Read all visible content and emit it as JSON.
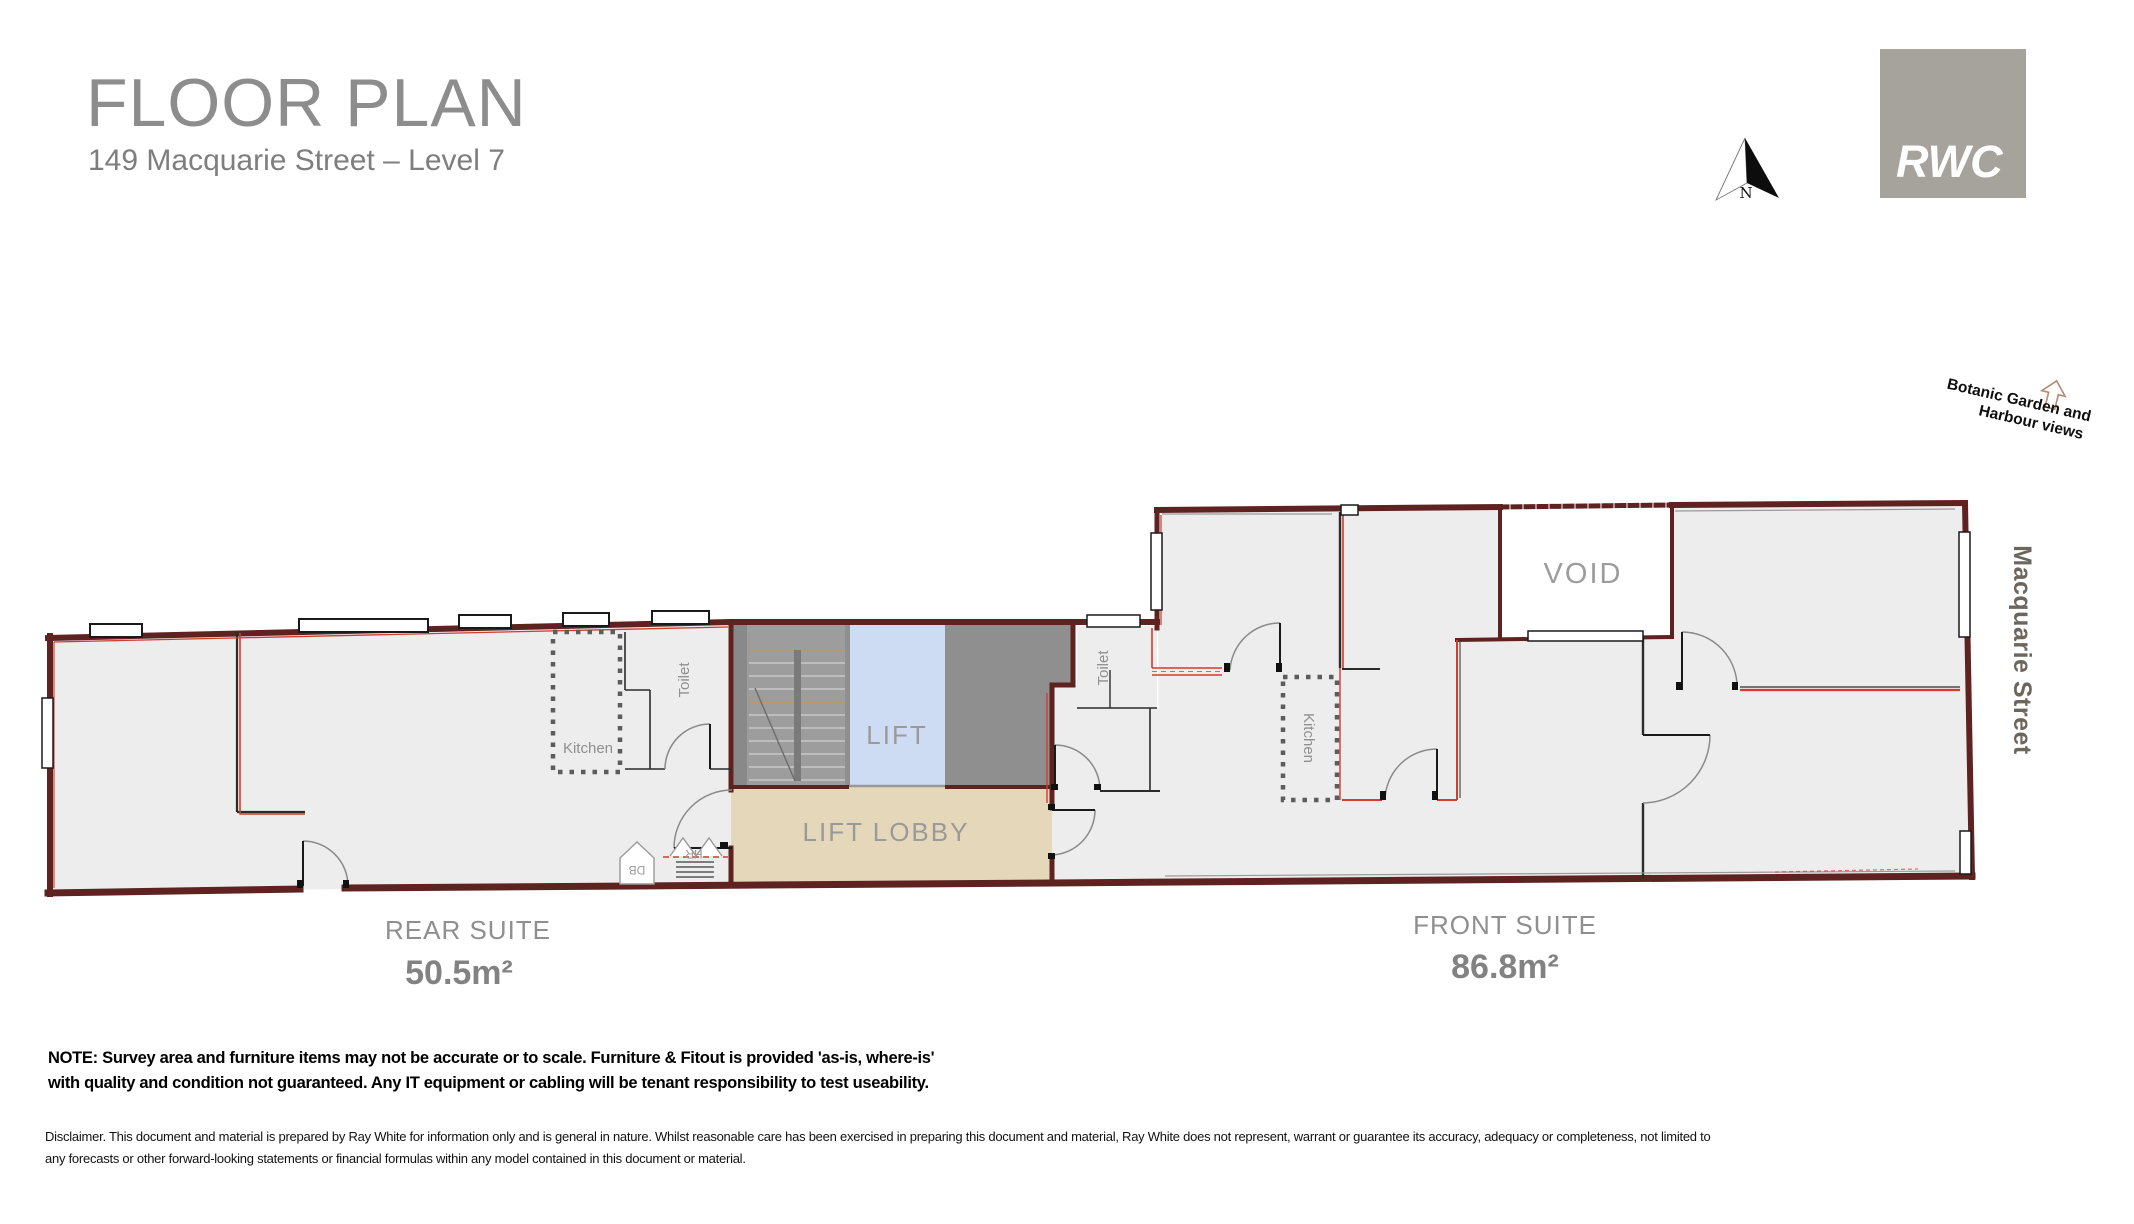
{
  "header": {
    "title": "FLOOR PLAN",
    "subtitle": "149 Macquarie Street – Level 7"
  },
  "branding": {
    "logo_text": "RWC"
  },
  "compass": {
    "letter": "N"
  },
  "annotations": {
    "view_line1": "Botanic Garden and",
    "view_line2": "Harbour views",
    "street": "Macquarie Street"
  },
  "plan": {
    "rooms": {
      "lift": "LIFT",
      "lift_lobby": "LIFT LOBBY",
      "void": "VOID",
      "kitchen_rear": "Kitchen",
      "toilet_rear": "Toilet",
      "kitchen_front": "Kitchen",
      "toilet_front": "Toilet",
      "db": "DB",
      "hr": "HR"
    },
    "suites": [
      {
        "name": "REAR SUITE",
        "area": "50.5m²"
      },
      {
        "name": "FRONT SUITE",
        "area": "86.8m²"
      }
    ],
    "colors": {
      "wall": "#5e2220",
      "partition": "#d23b2e",
      "floor": "#eeeded",
      "lobby": "#e5d8ba",
      "lift_shaft": "#cddcf2",
      "core": "#8f8f8f",
      "stair": "#9d9d9d",
      "void_fill": "#ffffff"
    }
  },
  "footer": {
    "note_line1": "NOTE: Survey area and furniture items may not be accurate or to scale. Furniture & Fitout is provided 'as-is, where-is'",
    "note_line2": "with quality and condition not guaranteed. Any IT equipment or cabling will be tenant responsibility to test useability.",
    "disclaimer_line1": "Disclaimer. This document and material is prepared by Ray White for information only and is general in nature.  Whilst reasonable care has been exercised in preparing this document and material,  Ray White does not represent, warrant or guarantee its accuracy, adequacy or completeness, not limited to",
    "disclaimer_line2": "any forecasts or other forward-looking statements or financial formulas within any model contained in this document or material."
  }
}
